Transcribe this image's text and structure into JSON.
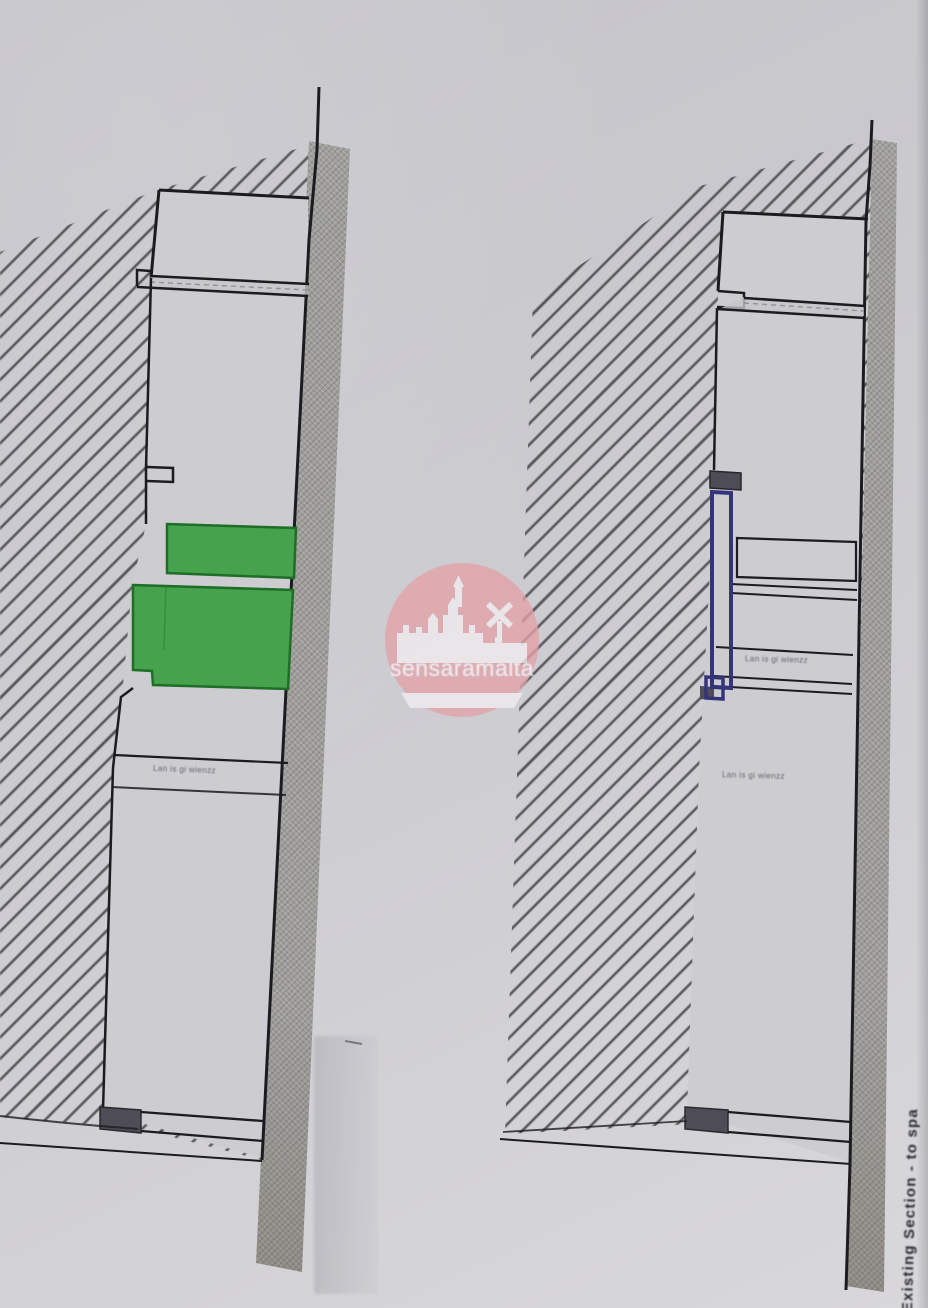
{
  "artwork": {
    "watermark": {
      "text": "sensaramalta"
    },
    "caption_vertical": "Existing Section - to spa",
    "annotations": {
      "left_floor_note": "Lan is gi wienzz",
      "right_shelf_note": "Lan is gi wienzz",
      "right_floor_note": "Lan is gi wienzz"
    },
    "colors": {
      "highlight_green": "#46a24c",
      "green_border": "#1e6e28",
      "frame_blue": "#34347a",
      "watermark_pink": "#e2a2a8",
      "wall_grey": "#9e9d9a",
      "hatch_line": "#3e3e42",
      "paper": "#cdccd1",
      "line_ink": "#1b1b20",
      "step_fill": "#4e4c55"
    }
  }
}
